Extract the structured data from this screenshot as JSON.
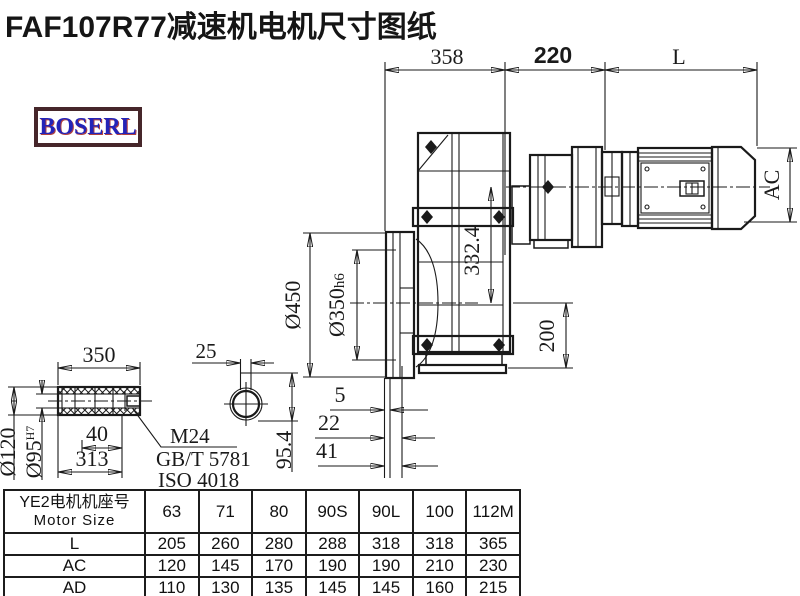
{
  "title": "FAF107R77减速机电机尺寸图纸",
  "logo": "BOSERL",
  "dims": {
    "top_358": "358",
    "top_220": "220",
    "top_L": "L",
    "ac": "AC",
    "d450": "Ø450",
    "d350": "Ø350",
    "d350_tol": "h6",
    "h332": "332.4",
    "h200": "200",
    "s5": "5",
    "s22": "22",
    "s41": "41",
    "shaft_350": "350",
    "shaft_40": "40",
    "shaft_313": "313",
    "d120": "Ø120",
    "d95": "Ø95",
    "d95_tol": "H7",
    "key_25": "25",
    "key_954": "95.4",
    "thread": "M24",
    "std_gb": "GB/T 5781",
    "std_iso": "ISO 4018"
  },
  "table": {
    "header_line1": "YE2电机机座号",
    "header_line2": "Motor Size",
    "columns": [
      "63",
      "71",
      "80",
      "90S",
      "90L",
      "100",
      "112M"
    ],
    "rows": [
      {
        "label": "L",
        "values": [
          "205",
          "260",
          "280",
          "288",
          "318",
          "318",
          "365"
        ]
      },
      {
        "label": "AC",
        "values": [
          "120",
          "145",
          "170",
          "190",
          "190",
          "210",
          "230"
        ]
      },
      {
        "label": "AD",
        "values": [
          "110",
          "130",
          "135",
          "145",
          "145",
          "160",
          "215"
        ]
      }
    ]
  }
}
